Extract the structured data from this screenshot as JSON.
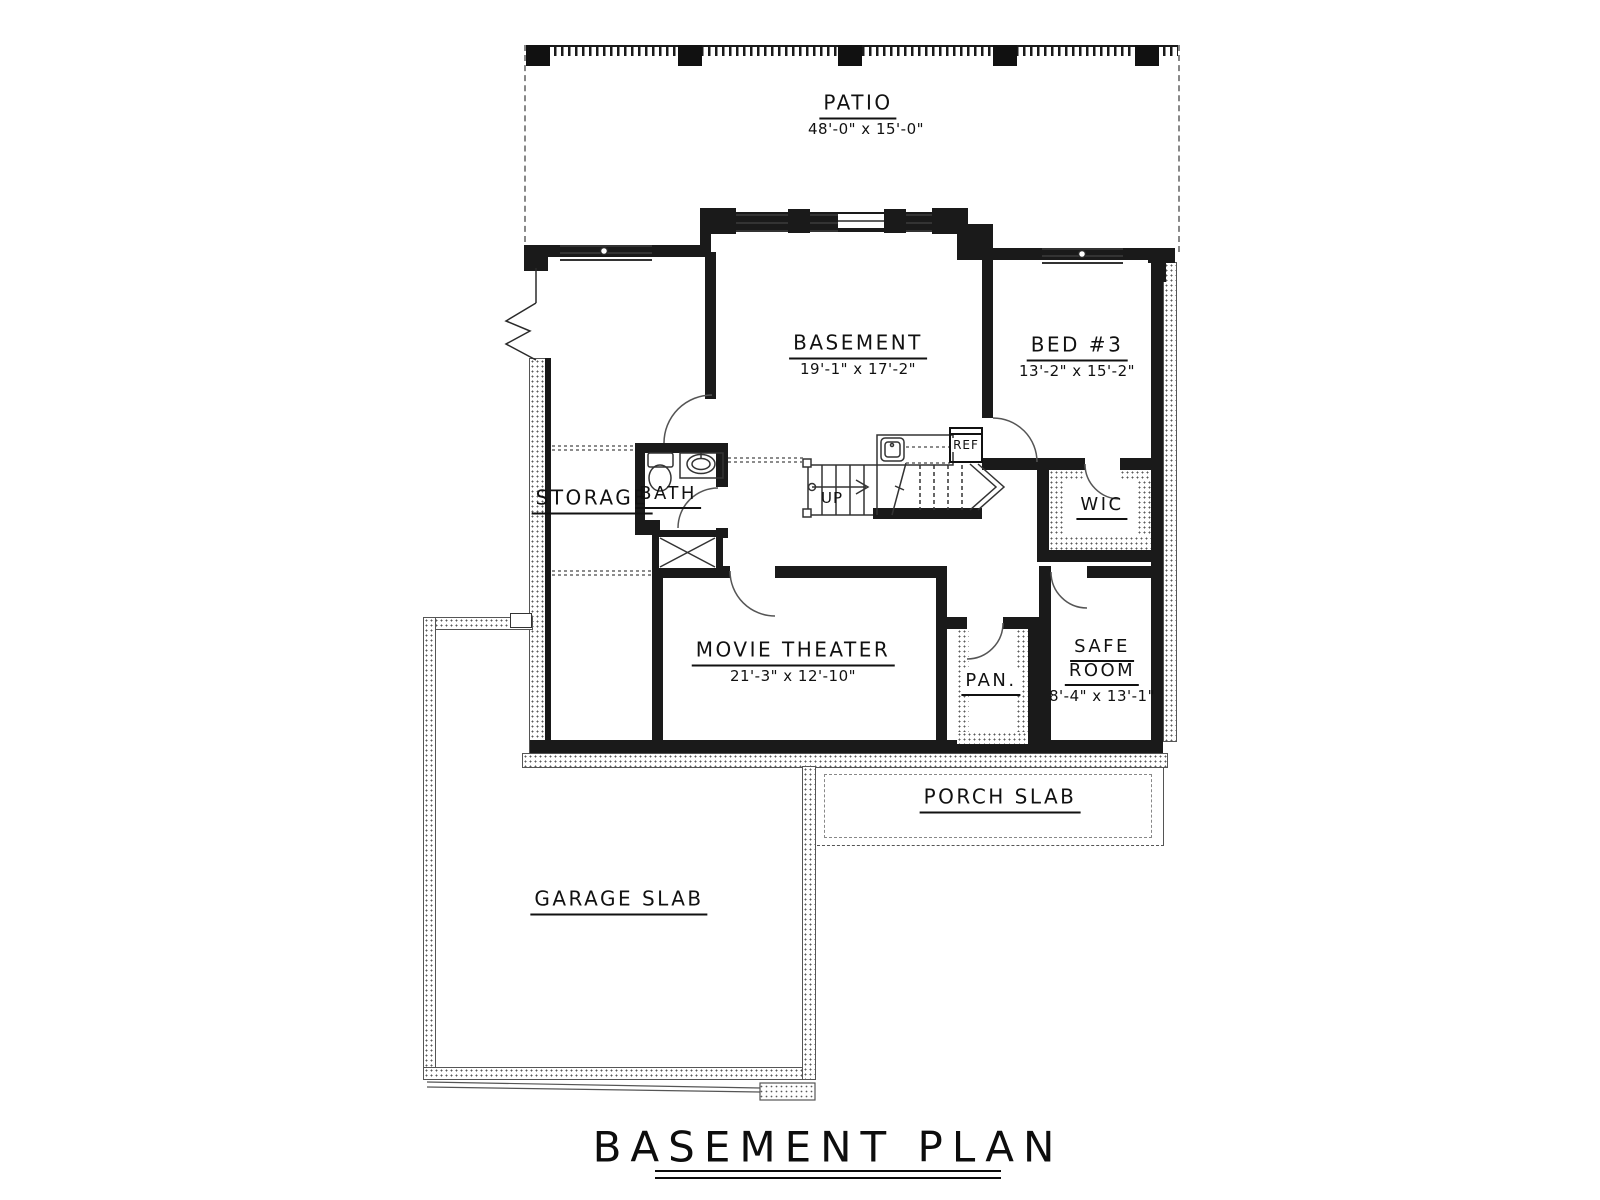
{
  "title": {
    "text": "BASEMENT PLAN"
  },
  "rooms": {
    "patio": {
      "name": "PATIO",
      "dims": "48'-0\" x 15'-0\""
    },
    "basement": {
      "name": "BASEMENT",
      "dims": "19'-1\" x 17'-2\""
    },
    "bed3": {
      "name": "BED #3",
      "dims": "13'-2\" x 15'-2\""
    },
    "storage": {
      "name": "STORAGE"
    },
    "bath": {
      "name": "BATH"
    },
    "wic": {
      "name": "WIC"
    },
    "movie_theater": {
      "name": "MOVIE THEATER",
      "dims": "21'-3\" x 12'-10\""
    },
    "pantry": {
      "name": "PAN."
    },
    "safe_room": {
      "name_line1": "SAFE",
      "name_line2": "ROOM",
      "dims": "8'-4\" x 13'-1\""
    },
    "porch": {
      "name": "PORCH SLAB"
    },
    "garage": {
      "name": "GARAGE SLAB"
    }
  },
  "annotations": {
    "stairs_direction": "UP",
    "fridge": "REF"
  },
  "colors": {
    "wall": "#1a1a1a",
    "line": "#2a2a2a",
    "stipple_dot": "#5a5a5a"
  }
}
